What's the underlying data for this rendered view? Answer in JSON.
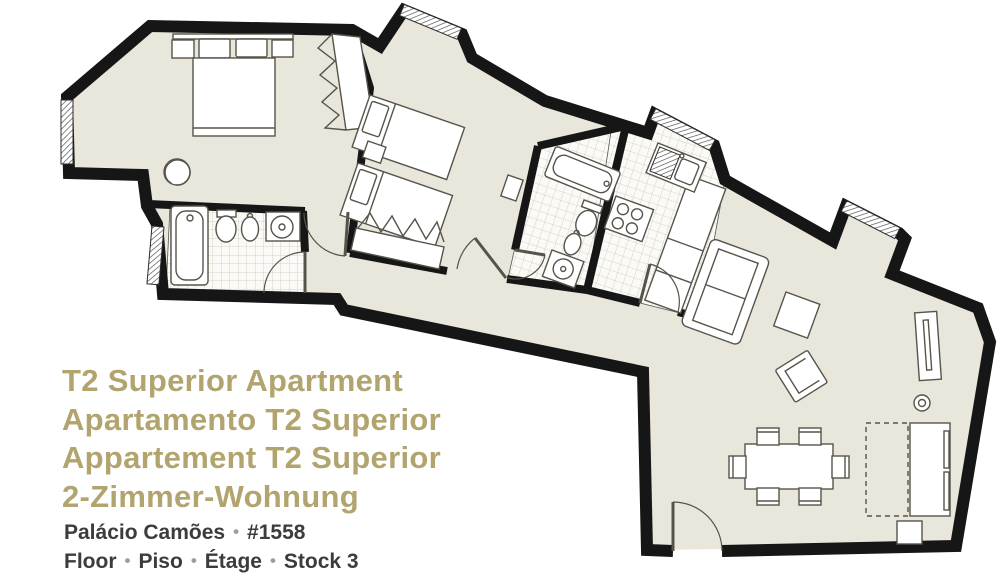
{
  "title": {
    "lines": [
      "T2 Superior Apartment",
      "Apartamento T2 Superior",
      "Appartement T2 Superior",
      "2-Zimmer-Wohnung"
    ]
  },
  "footer": {
    "separator": "•",
    "line1": {
      "parts": [
        "Palácio Camões",
        "#1558"
      ]
    },
    "line2": {
      "parts": [
        "Floor",
        "Piso",
        "Étage",
        "Stock 3"
      ]
    }
  },
  "plan": {
    "rooms": [
      "master-bedroom",
      "bathroom-1",
      "bedroom-2",
      "bathroom-2",
      "kitchen",
      "hall",
      "living-dining-room"
    ]
  },
  "theme": {
    "background": "#ffffff",
    "title_color": "#b2a46e",
    "footer_color": "#3c3c3c",
    "separator_color": "#a19d90",
    "wall_color": "#161616",
    "floor_color": "#e9e6dc",
    "tile_line_color": "#ccc9bc",
    "furniture_line_color": "#56544a"
  }
}
